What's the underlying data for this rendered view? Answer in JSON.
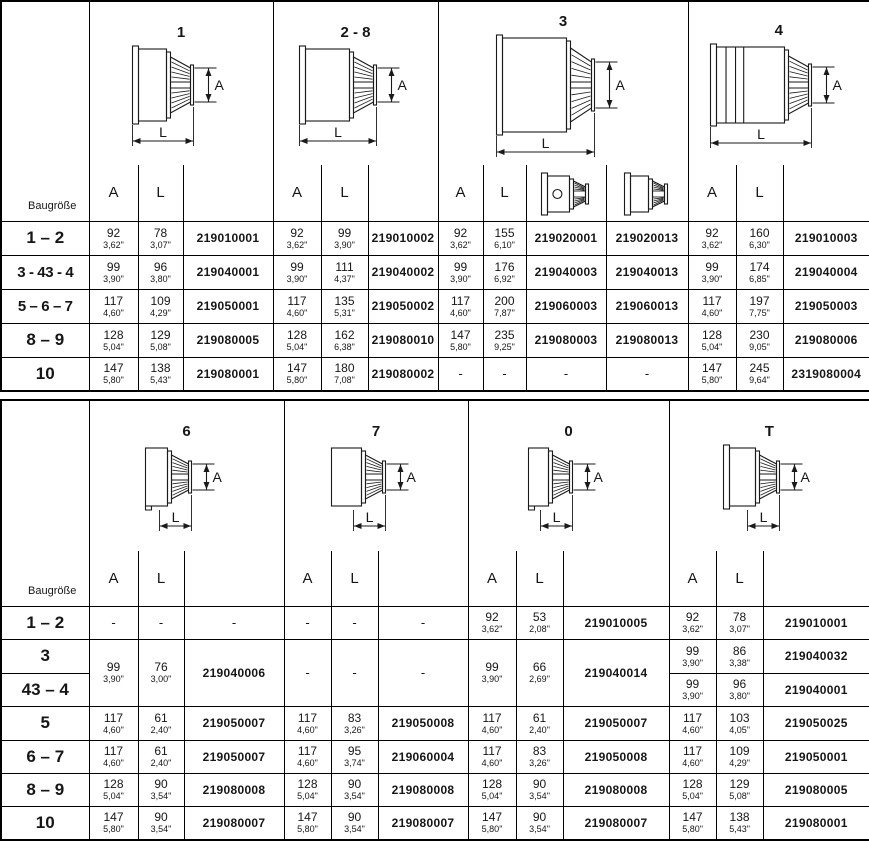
{
  "dim_labels": {
    "a": "A",
    "l": "L"
  },
  "tables": [
    {
      "name": "top",
      "row_header_label": "Baugröße",
      "sections": [
        {
          "title": "1",
          "a_label": "A",
          "l_label": "L",
          "icon": "drill-chuck-drawing-icon"
        },
        {
          "title": "2 - 8",
          "a_label": "A",
          "l_label": "L",
          "icon": "drill-chuck-drawing-icon"
        },
        {
          "title": "3",
          "a_label": "A",
          "l_label": "L",
          "icon": "drill-chuck-drawing-icon",
          "subheader_icons": [
            "chuck-face-keyhole-icon",
            "chuck-face-icon"
          ]
        },
        {
          "title": "4",
          "a_label": "A",
          "l_label": "L",
          "icon": "drill-chuck-drawing-icon"
        }
      ],
      "rows": [
        {
          "label": "1 – 2",
          "cells": [
            {
              "a_mm": "92",
              "a_in": "3,62\"",
              "l_mm": "78",
              "l_in": "3,07\"",
              "pn": [
                "219010001"
              ]
            },
            {
              "a_mm": "92",
              "a_in": "3,62\"",
              "l_mm": "99",
              "l_in": "3,90\"",
              "pn": [
                "219010002"
              ]
            },
            {
              "a_mm": "92",
              "a_in": "3,62\"",
              "l_mm": "155",
              "l_in": "6,10\"",
              "pn": [
                "219020001",
                "219020013"
              ]
            },
            {
              "a_mm": "92",
              "a_in": "3,62\"",
              "l_mm": "160",
              "l_in": "6,30\"",
              "pn": [
                "219010003"
              ]
            }
          ]
        },
        {
          "label": "3 - 43 - 4",
          "cells": [
            {
              "a_mm": "99",
              "a_in": "3,90\"",
              "l_mm": "96",
              "l_in": "3,80\"",
              "pn": [
                "219040001"
              ]
            },
            {
              "a_mm": "99",
              "a_in": "3,90\"",
              "l_mm": "111",
              "l_in": "4,37\"",
              "pn": [
                "219040002"
              ]
            },
            {
              "a_mm": "99",
              "a_in": "3,90\"",
              "l_mm": "176",
              "l_in": "6,92\"",
              "pn": [
                "219040003",
                "219040013"
              ]
            },
            {
              "a_mm": "99",
              "a_in": "3,90\"",
              "l_mm": "174",
              "l_in": "6,85\"",
              "pn": [
                "219040004"
              ]
            }
          ]
        },
        {
          "label": "5 – 6 – 7",
          "cells": [
            {
              "a_mm": "117",
              "a_in": "4,60\"",
              "l_mm": "109",
              "l_in": "4,29\"",
              "pn": [
                "219050001"
              ]
            },
            {
              "a_mm": "117",
              "a_in": "4,60\"",
              "l_mm": "135",
              "l_in": "5,31\"",
              "pn": [
                "219050002"
              ]
            },
            {
              "a_mm": "117",
              "a_in": "4,60\"",
              "l_mm": "200",
              "l_in": "7,87\"",
              "pn": [
                "219060003",
                "219060013"
              ]
            },
            {
              "a_mm": "117",
              "a_in": "4,60\"",
              "l_mm": "197",
              "l_in": "7,75\"",
              "pn": [
                "219050003"
              ]
            }
          ]
        },
        {
          "label": "8 – 9",
          "cells": [
            {
              "a_mm": "128",
              "a_in": "5,04\"",
              "l_mm": "129",
              "l_in": "5,08\"",
              "pn": [
                "219080005"
              ]
            },
            {
              "a_mm": "128",
              "a_in": "5,04\"",
              "l_mm": "162",
              "l_in": "6,38\"",
              "pn": [
                "219080010"
              ]
            },
            {
              "a_mm": "147",
              "a_in": "5,80\"",
              "l_mm": "235",
              "l_in": "9,25\"",
              "pn": [
                "219080003",
                "219080013"
              ]
            },
            {
              "a_mm": "128",
              "a_in": "5,04\"",
              "l_mm": "230",
              "l_in": "9,05\"",
              "pn": [
                "219080006"
              ]
            }
          ]
        },
        {
          "label": "10",
          "cells": [
            {
              "a_mm": "147",
              "a_in": "5,80\"",
              "l_mm": "138",
              "l_in": "5,43\"",
              "pn": [
                "219080001"
              ]
            },
            {
              "a_mm": "147",
              "a_in": "5,80\"",
              "l_mm": "180",
              "l_in": "7,08\"",
              "pn": [
                "219080002"
              ]
            },
            {
              "a_mm": "-",
              "l_mm": "-",
              "pn": [
                "-",
                "-"
              ]
            },
            {
              "a_mm": "147",
              "a_in": "5,80\"",
              "l_mm": "245",
              "l_in": "9,64\"",
              "pn": [
                "2319080004"
              ]
            }
          ]
        }
      ]
    },
    {
      "name": "bottom",
      "row_header_label": "Baugröße",
      "sections": [
        {
          "title": "6",
          "a_label": "A",
          "l_label": "L",
          "icon": "drill-chuck-drawing-icon"
        },
        {
          "title": "7",
          "a_label": "A",
          "l_label": "L",
          "icon": "drill-chuck-drawing-icon"
        },
        {
          "title": "0",
          "a_label": "A",
          "l_label": "L",
          "icon": "drill-chuck-drawing-icon"
        },
        {
          "title": "T",
          "a_label": "A",
          "l_label": "L",
          "icon": "drill-chuck-drawing-icon"
        }
      ],
      "rows": [
        {
          "label": "1 – 2",
          "cells": [
            {
              "a_mm": "-",
              "l_mm": "-",
              "pn": [
                "-"
              ]
            },
            {
              "a_mm": "-",
              "l_mm": "-",
              "pn": [
                "-"
              ]
            },
            {
              "a_mm": "92",
              "a_in": "3,62\"",
              "l_mm": "53",
              "l_in": "2,08\"",
              "pn": [
                "219010005"
              ]
            },
            {
              "a_mm": "92",
              "a_in": "3,62\"",
              "l_mm": "78",
              "l_in": "3,07\"",
              "pn": [
                "219010001"
              ]
            }
          ]
        },
        {
          "label": "3",
          "cells": [
            {
              "a_mm": "99",
              "a_in": "3,90\"",
              "l_mm": "76",
              "l_in": "3,00\"",
              "pn": [
                "219040006"
              ],
              "rowspan": 2
            },
            {
              "a_mm": "-",
              "l_mm": "-",
              "pn": [
                "-"
              ],
              "rowspan": 2
            },
            {
              "a_mm": "99",
              "a_in": "3,90\"",
              "l_mm": "66",
              "l_in": "2,69\"",
              "pn": [
                "219040014"
              ],
              "rowspan": 2
            },
            {
              "a_mm": "99",
              "a_in": "3,90\"",
              "l_mm": "86",
              "l_in": "3,38\"",
              "pn": [
                "219040032"
              ]
            }
          ]
        },
        {
          "label": "43 – 4",
          "cells": [
            null,
            null,
            null,
            {
              "a_mm": "99",
              "a_in": "3,90\"",
              "l_mm": "96",
              "l_in": "3,80\"",
              "pn": [
                "219040001"
              ]
            }
          ]
        },
        {
          "label": "5",
          "cells": [
            {
              "a_mm": "117",
              "a_in": "4,60\"",
              "l_mm": "61",
              "l_in": "2,40\"",
              "pn": [
                "219050007"
              ]
            },
            {
              "a_mm": "117",
              "a_in": "4,60\"",
              "l_mm": "83",
              "l_in": "3,26\"",
              "pn": [
                "219050008"
              ]
            },
            {
              "a_mm": "117",
              "a_in": "4,60\"",
              "l_mm": "61",
              "l_in": "2,40\"",
              "pn": [
                "219050007"
              ]
            },
            {
              "a_mm": "117",
              "a_in": "4,60\"",
              "l_mm": "103",
              "l_in": "4,05\"",
              "pn": [
                "219050025"
              ]
            }
          ]
        },
        {
          "label": "6 – 7",
          "cells": [
            {
              "a_mm": "117",
              "a_in": "4,60\"",
              "l_mm": "61",
              "l_in": "2,40\"",
              "pn": [
                "219050007"
              ]
            },
            {
              "a_mm": "117",
              "a_in": "4,60\"",
              "l_mm": "95",
              "l_in": "3,74\"",
              "pn": [
                "219060004"
              ]
            },
            {
              "a_mm": "117",
              "a_in": "4,60\"",
              "l_mm": "83",
              "l_in": "3,26\"",
              "pn": [
                "219050008"
              ]
            },
            {
              "a_mm": "117",
              "a_in": "4,60\"",
              "l_mm": "109",
              "l_in": "4,29\"",
              "pn": [
                "219050001"
              ]
            }
          ]
        },
        {
          "label": "8 – 9",
          "cells": [
            {
              "a_mm": "128",
              "a_in": "5,04\"",
              "l_mm": "90",
              "l_in": "3,54\"",
              "pn": [
                "219080008"
              ]
            },
            {
              "a_mm": "128",
              "a_in": "5,04\"",
              "l_mm": "90",
              "l_in": "3,54\"",
              "pn": [
                "219080008"
              ]
            },
            {
              "a_mm": "128",
              "a_in": "5,04\"",
              "l_mm": "90",
              "l_in": "3,54\"",
              "pn": [
                "219080008"
              ]
            },
            {
              "a_mm": "128",
              "a_in": "5,04\"",
              "l_mm": "129",
              "l_in": "5,08\"",
              "pn": [
                "219080005"
              ]
            }
          ]
        },
        {
          "label": "10",
          "cells": [
            {
              "a_mm": "147",
              "a_in": "5,80\"",
              "l_mm": "90",
              "l_in": "3,54\"",
              "pn": [
                "219080007"
              ]
            },
            {
              "a_mm": "147",
              "a_in": "5,80\"",
              "l_mm": "90",
              "l_in": "3,54\"",
              "pn": [
                "219080007"
              ]
            },
            {
              "a_mm": "147",
              "a_in": "5,80\"",
              "l_mm": "90",
              "l_in": "3,54\"",
              "pn": [
                "219080007"
              ]
            },
            {
              "a_mm": "147",
              "a_in": "5,80\"",
              "l_mm": "138",
              "l_in": "5,43\"",
              "pn": [
                "219080001"
              ]
            }
          ]
        }
      ]
    }
  ]
}
